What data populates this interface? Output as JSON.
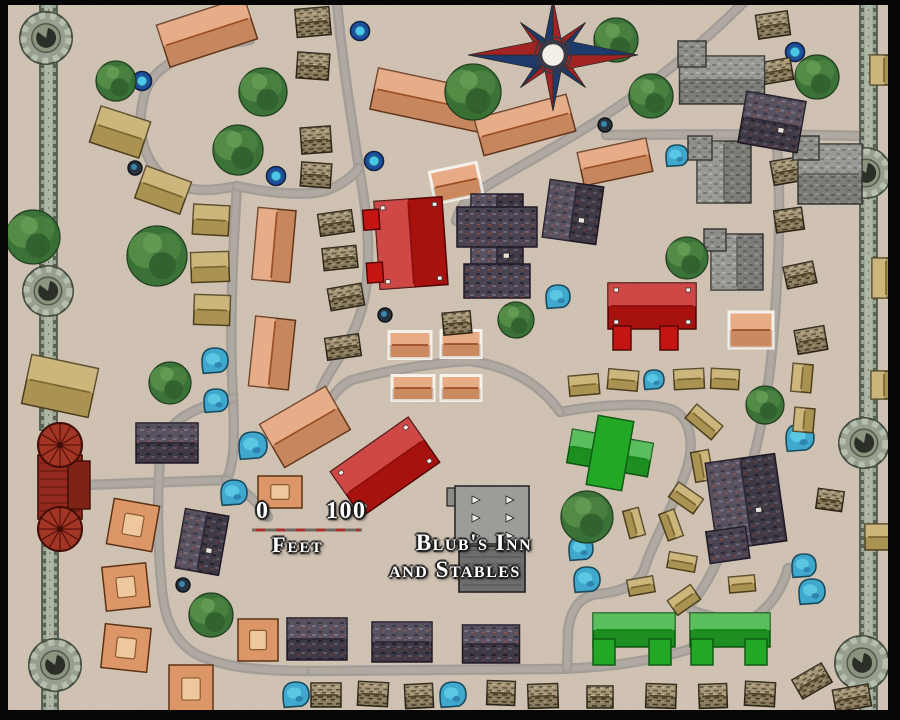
{
  "ui": {
    "scale": {
      "zero": "0",
      "hundred": "100",
      "unit": "Feet"
    },
    "label": {
      "line1": "Blub's Inn",
      "line2": "and Stables"
    }
  },
  "map": {
    "colors": {
      "parchment": "#d3c5b6",
      "road": "#a29d96",
      "road_inner": "#b3ada5",
      "wall": "#97a292",
      "wall_edge": "#454d42",
      "frame": "#060606",
      "orange_roof": "#e2996b",
      "tan_roof": "#c2a75e",
      "thatch": "#9c8c6a",
      "stone": "#8e8e8a",
      "slate": "#4a4352",
      "red_building": "#c31511",
      "green_building": "#23a826",
      "gatehouse_red": "#a23524",
      "well_ring": "#1c4e9e",
      "well_water": "#49c8e8",
      "pond": "#3fa8cc",
      "compass_navy": "#1d3a6d",
      "compass_red": "#a32222",
      "tree": "#356f33"
    },
    "frame": {
      "top": 5,
      "left": 8,
      "right": 12,
      "bottom": 10
    },
    "roads": [
      "M 250,40 C 195,48 152,62 144,96 C 136,128 142,160 166,179 C 192,196 222,189 237,186",
      "M 237,186 C 233,250 229,330 233,398 C 235,442 234,466 226,480",
      "M 86,485 C 130,483 180,482 226,480",
      "M 226,480 C 246,492 258,502 268,517",
      "M 233,398 C 196,407 166,419 161,450 C 156,495 158,552 162,590 C 165,622 176,641 194,653 C 222,668 262,671 312,671",
      "M 312,671 L 556,669 C 632,667 692,654 737,629 C 767,612 781,594 788,568",
      "M 337,2 C 342,60 352,122 359,168 C 369,224 371,264 364,300 C 356,337 337,359 325,381 C 318,393 317,403 321,415",
      "M 237,186 C 268,193 308,197 328,190 C 343,184 352,177 359,168",
      "M 744,2 C 702,44 652,86 592,124 C 548,152 512,170 482,189 C 466,199 459,209 456,221",
      "M 606,135 C 690,134 780,134 866,136",
      "M 776,137 C 782,200 778,280 773,340 C 768,400 756,458 738,508 C 723,552 708,585 692,602 C 682,613 705,612 728,622",
      "M 560,412 C 602,404 652,402 673,410 C 692,419 695,447 685,474 C 670,514 652,544 645,567 C 640,584 622,592 598,594 C 580,596 570,610 568,632 L 567,668",
      "M 321,415 C 330,400 338,386 352,380 C 395,368 445,362 470,361 C 515,367 543,388 560,412"
    ],
    "walls": [
      {
        "x": 40,
        "y": 0,
        "w": 17,
        "h": 430
      },
      {
        "x": 42,
        "y": 543,
        "w": 16,
        "h": 169
      },
      {
        "x": 860,
        "y": 0,
        "w": 17,
        "h": 712
      }
    ],
    "towers": [
      [
        46,
        38,
        26
      ],
      [
        48,
        291,
        25
      ],
      [
        55,
        665,
        26
      ],
      [
        866,
        173,
        25
      ],
      [
        864,
        443,
        25
      ],
      [
        862,
        663,
        27
      ]
    ],
    "gatehouse": {
      "x": 60,
      "y": 487
    },
    "inn": {
      "x": 492,
      "y": 548
    },
    "compass": {
      "cx": 553,
      "cy": 55
    },
    "scalebar": {
      "x1": 252,
      "x2": 362,
      "y": 530
    },
    "buildings": [
      [
        "orange",
        207,
        32,
        92,
        44,
        -18
      ],
      [
        "orange",
        428,
        100,
        110,
        42,
        12
      ],
      [
        "orange",
        525,
        125,
        95,
        38,
        -15
      ],
      [
        "barn",
        456,
        183,
        48,
        32,
        -12
      ],
      [
        "orange",
        615,
        162,
        70,
        34,
        -12
      ],
      [
        "barn",
        751,
        330,
        44,
        36,
        0
      ],
      [
        "orange",
        274,
        245,
        38,
        72,
        5
      ],
      [
        "orange",
        272,
        353,
        40,
        70,
        6
      ],
      [
        "orange",
        305,
        427,
        76,
        50,
        -30
      ],
      [
        "barn",
        410,
        345,
        42,
        27,
        0
      ],
      [
        "barn",
        461,
        344,
        40,
        27,
        0
      ],
      [
        "barn",
        413,
        388,
        42,
        25,
        0
      ],
      [
        "barn",
        461,
        388,
        40,
        25,
        0
      ],
      [
        "court",
        133,
        525,
        46,
        46,
        10
      ],
      [
        "court",
        126,
        587,
        44,
        44,
        -6
      ],
      [
        "court",
        126,
        648,
        46,
        44,
        6
      ],
      [
        "court",
        191,
        689,
        44,
        48,
        0
      ],
      [
        "court",
        258,
        640,
        40,
        42,
        0
      ],
      [
        "court",
        280,
        492,
        44,
        32,
        0
      ],
      [
        "tan",
        120,
        132,
        52,
        38,
        18
      ],
      [
        "tan",
        163,
        190,
        48,
        34,
        20
      ],
      [
        "tan",
        211,
        220,
        36,
        30,
        3
      ],
      [
        "tan",
        210,
        267,
        38,
        30,
        -2
      ],
      [
        "tan",
        212,
        310,
        36,
        30,
        2
      ],
      [
        "tan",
        60,
        386,
        68,
        50,
        12
      ],
      [
        "tan",
        584,
        385,
        30,
        20,
        -5
      ],
      [
        "tan",
        623,
        380,
        30,
        20,
        5
      ],
      [
        "tan",
        689,
        379,
        30,
        20,
        -3
      ],
      [
        "tan",
        725,
        379,
        28,
        20,
        3
      ],
      [
        "tan",
        704,
        422,
        34,
        18,
        40
      ],
      [
        "tan",
        702,
        466,
        30,
        18,
        80
      ],
      [
        "tan",
        686,
        498,
        30,
        18,
        35
      ],
      [
        "tan",
        671,
        525,
        28,
        16,
        70
      ],
      [
        "tan",
        634,
        523,
        28,
        16,
        75
      ],
      [
        "tan",
        682,
        562,
        28,
        16,
        10
      ],
      [
        "tan",
        802,
        378,
        20,
        28,
        5
      ],
      [
        "tan",
        804,
        420,
        20,
        24,
        5
      ],
      [
        "tan",
        641,
        586,
        26,
        16,
        -10
      ],
      [
        "tan",
        684,
        600,
        28,
        18,
        -35
      ],
      [
        "tan",
        742,
        584,
        26,
        16,
        -5
      ],
      [
        "tan",
        884,
        70,
        28,
        30,
        0
      ],
      [
        "tan",
        886,
        278,
        28,
        40,
        0
      ],
      [
        "tan",
        884,
        385,
        26,
        28,
        0
      ],
      [
        "tan",
        880,
        537,
        30,
        26,
        0
      ],
      [
        "thatch",
        313,
        22,
        34,
        28,
        -5
      ],
      [
        "thatch",
        313,
        66,
        32,
        26,
        4
      ],
      [
        "thatch",
        316,
        140,
        30,
        26,
        -4
      ],
      [
        "thatch",
        316,
        175,
        30,
        24,
        4
      ],
      [
        "thatch",
        336,
        223,
        34,
        22,
        -8
      ],
      [
        "thatch",
        340,
        258,
        34,
        22,
        -6
      ],
      [
        "thatch",
        346,
        297,
        34,
        22,
        -10
      ],
      [
        "thatch",
        343,
        347,
        34,
        22,
        -8
      ],
      [
        "thatch",
        457,
        323,
        28,
        22,
        -5
      ],
      [
        "thatch",
        773,
        25,
        32,
        24,
        -8
      ],
      [
        "thatch",
        777,
        71,
        30,
        22,
        -10
      ],
      [
        "thatch",
        784,
        119,
        28,
        22,
        -12
      ],
      [
        "thatch",
        787,
        171,
        30,
        24,
        -10
      ],
      [
        "thatch",
        789,
        220,
        28,
        22,
        -8
      ],
      [
        "thatch",
        800,
        275,
        30,
        22,
        -12
      ],
      [
        "thatch",
        811,
        340,
        30,
        24,
        -10
      ],
      [
        "thatch",
        326,
        695,
        30,
        24,
        0
      ],
      [
        "thatch",
        373,
        694,
        30,
        24,
        3
      ],
      [
        "thatch",
        419,
        696,
        28,
        24,
        -3
      ],
      [
        "thatch",
        501,
        693,
        28,
        24,
        2
      ],
      [
        "thatch",
        543,
        696,
        30,
        24,
        -2
      ],
      [
        "thatch",
        600,
        697,
        26,
        22,
        0
      ],
      [
        "thatch",
        661,
        696,
        30,
        24,
        2
      ],
      [
        "thatch",
        713,
        696,
        28,
        24,
        -2
      ],
      [
        "thatch",
        760,
        694,
        30,
        24,
        3
      ],
      [
        "thatch",
        812,
        681,
        34,
        22,
        -30
      ],
      [
        "thatch",
        852,
        698,
        36,
        22,
        -10
      ],
      [
        "thatch",
        830,
        500,
        26,
        20,
        8
      ],
      [
        "stone",
        722,
        80,
        85,
        48,
        0,
        [
          [
            -30,
            -26,
            28,
            26
          ]
        ]
      ],
      [
        "stone",
        724,
        172,
        54,
        62,
        0,
        [
          [
            -24,
            -24,
            24,
            24
          ]
        ]
      ],
      [
        "stone",
        830,
        174,
        64,
        60,
        0,
        [
          [
            -24,
            -26,
            26,
            24
          ]
        ]
      ],
      [
        "stone",
        737,
        262,
        52,
        56,
        0,
        [
          [
            -22,
            -22,
            22,
            22
          ]
        ]
      ],
      [
        "slate",
        497,
        245,
        52,
        102,
        0,
        [
          [
            0,
            -18,
            80,
            40
          ],
          [
            0,
            36,
            66,
            34
          ]
        ]
      ],
      [
        "slate",
        573,
        212,
        54,
        58,
        8
      ],
      [
        "slate",
        772,
        122,
        60,
        52,
        10
      ],
      [
        "slate",
        167,
        443,
        62,
        40,
        0
      ],
      [
        "slate",
        202,
        542,
        44,
        60,
        10
      ],
      [
        "slate",
        317,
        639,
        60,
        42,
        0
      ],
      [
        "slate",
        402,
        642,
        60,
        40,
        0
      ],
      [
        "slate",
        491,
        644,
        57,
        38,
        0
      ],
      [
        "slate",
        746,
        502,
        70,
        88,
        -8,
        [
          [
            -24,
            40,
            40,
            32
          ]
        ]
      ],
      [
        "red",
        411,
        243,
        68,
        88,
        -4,
        [
          [
            -38,
            -26,
            16,
            20
          ],
          [
            -38,
            27,
            16,
            20
          ]
        ]
      ],
      [
        "red",
        652,
        306,
        88,
        46,
        0,
        [
          [
            -30,
            32,
            18,
            24
          ],
          [
            17,
            32,
            18,
            24
          ]
        ]
      ],
      [
        "red",
        385,
        467,
        95,
        55,
        -35
      ],
      [
        "green",
        610,
        453,
        82,
        34,
        10,
        [
          [
            0,
            0,
            36,
            70
          ]
        ]
      ],
      [
        "green",
        634,
        630,
        82,
        34,
        0,
        [
          [
            -30,
            22,
            22,
            26
          ],
          [
            26,
            22,
            22,
            26
          ]
        ]
      ],
      [
        "green",
        730,
        630,
        80,
        34,
        0,
        [
          [
            -28,
            22,
            22,
            26
          ],
          [
            26,
            22,
            22,
            26
          ]
        ]
      ]
    ],
    "trees": [
      [
        116,
        81,
        20
      ],
      [
        263,
        92,
        24
      ],
      [
        238,
        150,
        25
      ],
      [
        33,
        237,
        27
      ],
      [
        157,
        256,
        30
      ],
      [
        170,
        383,
        21
      ],
      [
        473,
        92,
        28
      ],
      [
        616,
        40,
        22
      ],
      [
        651,
        96,
        22
      ],
      [
        516,
        320,
        18
      ],
      [
        687,
        258,
        21
      ],
      [
        765,
        405,
        19
      ],
      [
        817,
        77,
        22
      ],
      [
        587,
        517,
        26
      ],
      [
        211,
        615,
        22
      ]
    ],
    "wells": [
      [
        142,
        81
      ],
      [
        360,
        31
      ],
      [
        795,
        52
      ],
      [
        374,
        161
      ],
      [
        276,
        176
      ]
    ],
    "dark_wells": [
      [
        605,
        125
      ],
      [
        135,
        168
      ],
      [
        183,
        585
      ],
      [
        385,
        315
      ],
      [
        474,
        497
      ]
    ],
    "ponds": [
      [
        215,
        361,
        13
      ],
      [
        216,
        401,
        12
      ],
      [
        253,
        446,
        14
      ],
      [
        234,
        493,
        13
      ],
      [
        558,
        297,
        12
      ],
      [
        800,
        438,
        14
      ],
      [
        654,
        380,
        10
      ],
      [
        677,
        156,
        11
      ],
      [
        581,
        549,
        12
      ],
      [
        587,
        580,
        13
      ],
      [
        804,
        566,
        12
      ],
      [
        812,
        592,
        13
      ],
      [
        296,
        695,
        13
      ],
      [
        453,
        695,
        13
      ]
    ]
  }
}
